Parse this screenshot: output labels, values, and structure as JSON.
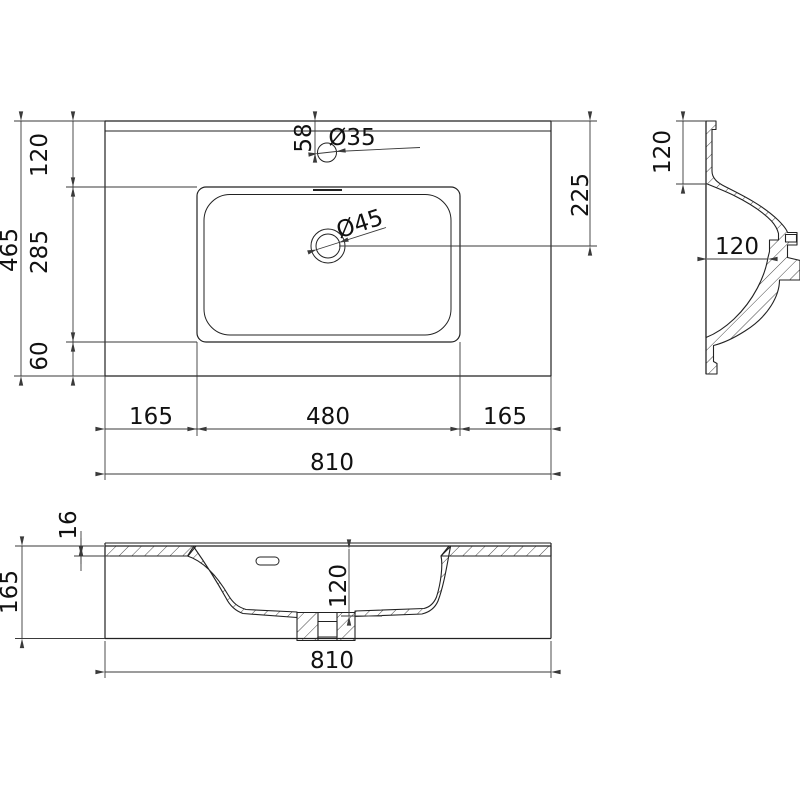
{
  "drawing": {
    "title_hint": "washbasin-dimension-drawing",
    "plan": {
      "height_total": "465",
      "zone_back": "120",
      "zone_basin": "285",
      "zone_front": "60",
      "faucet_offset": "58",
      "faucet_dia": "Ø35",
      "drain_dia": "Ø45",
      "drain_offset": "225",
      "margin_left": "165",
      "basin_width": "480",
      "margin_right": "165",
      "width_total": "810"
    },
    "side": {
      "rim_depth": "120",
      "inner_width": "120"
    },
    "front": {
      "top_thickness": "16",
      "height_total": "165",
      "bowl_depth": "120",
      "width_total": "810"
    }
  },
  "colors": {
    "background": "#ffffff",
    "outline": "#222222",
    "dimension": "#3a3a3a",
    "text": "#111111"
  }
}
